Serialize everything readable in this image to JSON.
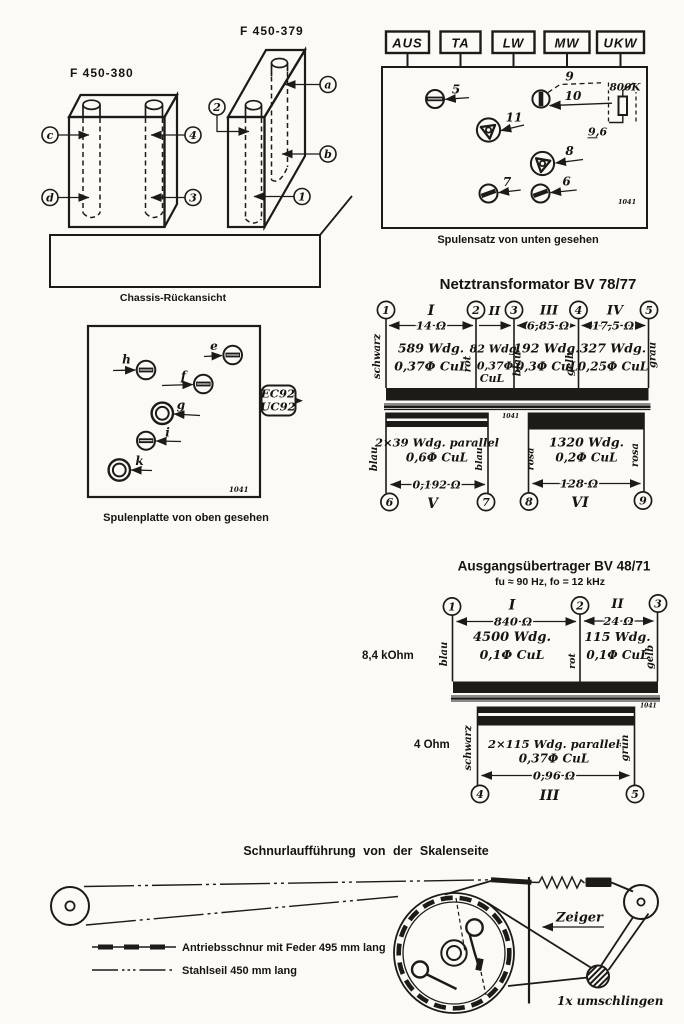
{
  "palette": {
    "ink": "#1c1b18",
    "paper": "#fbfaf7"
  },
  "chassis": {
    "part_left": "F 450-380",
    "part_right": "F 450-379",
    "caption": "Chassis-Rückansicht",
    "callout_c": "c",
    "callout_d": "d",
    "callout_4": "4",
    "callout_3": "3",
    "callout_2": "2",
    "callout_a": "a",
    "callout_b": "b",
    "callout_1": "1"
  },
  "spulensatz": {
    "buttons": [
      {
        "label": "AUS"
      },
      {
        "label": "TA"
      },
      {
        "label": "LW"
      },
      {
        "label": "MW"
      },
      {
        "label": "UKW"
      }
    ],
    "t5": "5",
    "t6": "6",
    "t7": "7",
    "t8": "8",
    "t9": "9",
    "t10": "10",
    "t11": "11",
    "resistor_label": "800K",
    "resistor_value": "9,6",
    "stamp": "1041",
    "caption": "Spulensatz von unten gesehen"
  },
  "spulenplatte": {
    "e": "e",
    "f": "f",
    "g": "g",
    "h": "h",
    "i": "i",
    "k": "k",
    "tube_line1": "EC92",
    "tube_line2": "UC92",
    "stamp": "1041",
    "caption": "Spulenplatte von oben gesehen"
  },
  "netztrafo": {
    "title": "Netztransformator BV 78/77",
    "t1": "1",
    "t2": "2",
    "t3": "3",
    "t4": "4",
    "t5": "5",
    "t6": "6",
    "t7": "7",
    "t8": "8",
    "t9": "9",
    "s1": {
      "numeral": "I",
      "resistance": "14 Ω",
      "turns": "589 Wdg.",
      "wire": "0,37Φ CuL"
    },
    "s2": {
      "numeral": "II",
      "turns": "82 Wdg.",
      "wire_a": "0,37Φ",
      "wire_b": "CuL"
    },
    "s3": {
      "numeral": "III",
      "resistance": "6,85 Ω",
      "turns": "192 Wdg.",
      "wire": "0,3Φ CuL"
    },
    "s4": {
      "numeral": "IV",
      "resistance": "17,5 Ω",
      "turns": "327 Wdg.",
      "wire": "0,25Φ CuL"
    },
    "s5": {
      "numeral": "V",
      "turns": "2×39 Wdg. parallel",
      "wire": "0,6Φ CuL",
      "resistance": "0,192 Ω"
    },
    "s6": {
      "numeral": "VI",
      "turns": "1320 Wdg.",
      "wire": "0,2Φ CuL",
      "resistance": "128 Ω"
    },
    "color_1": "schwarz",
    "color_2": "rot",
    "color_3": "blau",
    "color_4": "gelb",
    "color_5": "grau",
    "color_6": "blau",
    "color_7": "blau",
    "color_8": "rosa",
    "color_9": "rosa",
    "stamp": "1041"
  },
  "ausgang": {
    "title": "Ausgangsübertrager BV 48/71",
    "subtitle": "fu ≈ 90 Hz,  fo = 12 kHz",
    "impedance_primary": "8,4 kOhm",
    "impedance_secondary": "4 Ohm",
    "t1": "1",
    "t2": "2",
    "t3": "3",
    "t4": "4",
    "t5": "5",
    "s1": {
      "numeral": "I",
      "resistance": "840 Ω",
      "turns": "4500 Wdg.",
      "wire": "0,1Φ CuL"
    },
    "s2": {
      "numeral": "II",
      "resistance": "24 Ω",
      "turns": "115 Wdg.",
      "wire": "0,1Φ CuL"
    },
    "s3": {
      "numeral": "III",
      "turns": "2×115 Wdg. parallel",
      "wire": "0,37Φ CuL",
      "resistance": "0,96 Ω"
    },
    "color_1": "blau",
    "color_2": "rot",
    "color_3": "gelb",
    "color_4": "schwarz",
    "color_5": "grün",
    "stamp": "1041"
  },
  "schnurlauf": {
    "title": "Schnurlaufführung von der Skalenseite",
    "legend_cord": "Antriebsschnur mit Feder 495 mm lang",
    "legend_cable": "Stahlseil 450 mm lang",
    "pointer_label": "Zeiger",
    "wrap_note": "1x umschlingen"
  }
}
